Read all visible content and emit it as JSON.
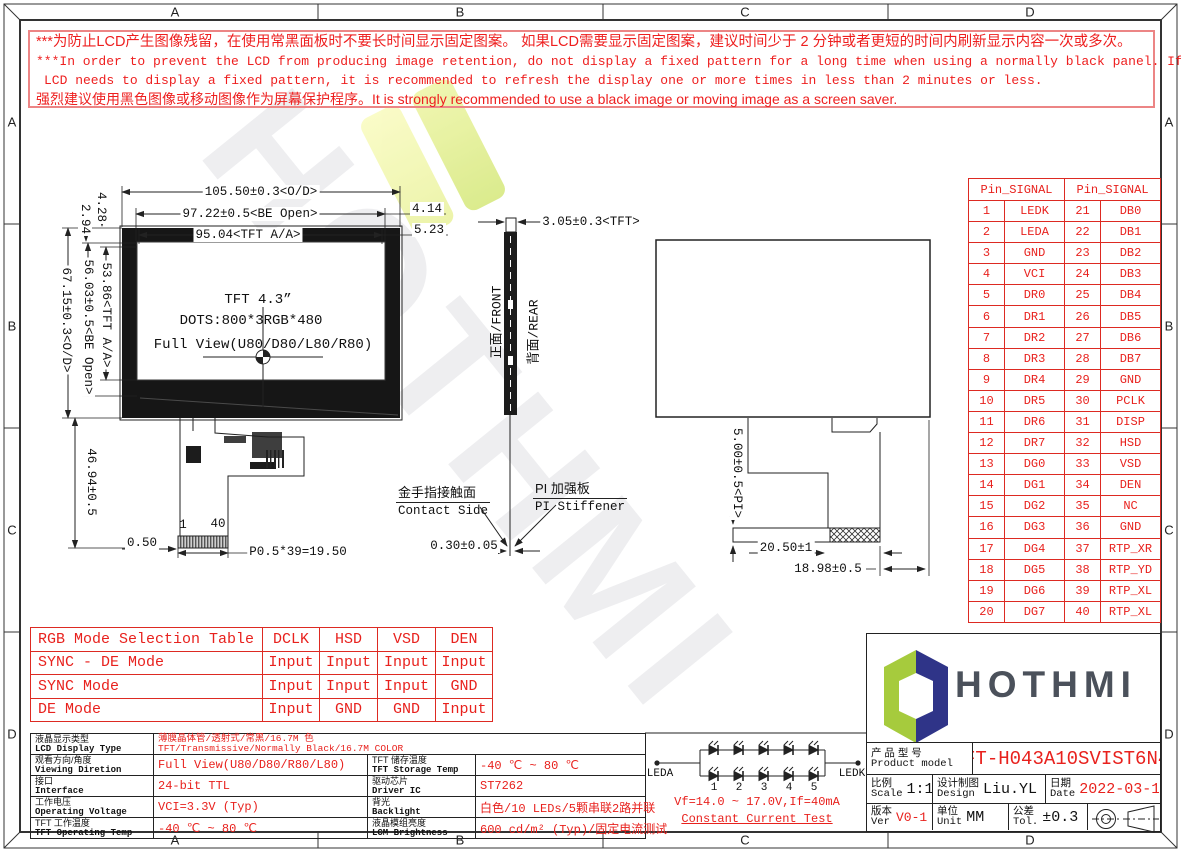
{
  "frame": {
    "zones": [
      "A",
      "B",
      "C",
      "D"
    ]
  },
  "warning": {
    "line1": "***为防止LCD产生图像残留，在使用常黑面板时不要长时间显示固定图案。 如果LCD需要显示固定图案，建议时间少于 2 分钟或者更短的时间内刷新显示内容一次或多次。",
    "line2": "***In order to prevent the LCD from producing image retention, do not display a fixed pattern for a long time when using a normally black panel. If the",
    "line3": "LCD needs to display a fixed pattern, it is recommended to refresh the display one or more times in less than 2 minutes or less.",
    "line4": "强烈建议使用黑色图像或移动图像作为屏幕保护程序。It is strongly recommended to use a black image or moving image as a screen saver."
  },
  "drawing": {
    "panel_text": {
      "line1": "TFT 4.3”",
      "line2": "DOTS:800*3RGB*480",
      "line3": "Full View(U80/D80/L80/R80)"
    },
    "dims": {
      "od_w": "105.50±0.3<O/D>",
      "be_w": "97.22±0.5<BE Open>",
      "aa_w": "95.04<TFT A/A>",
      "gap1": "4.14",
      "gap2": "5.23",
      "gap3": "4.28",
      "gap4": "2.94",
      "aa_h": "53.86<TFT A/A>",
      "be_h": "56.03±0.5<BE Open>",
      "od_h": "67.15±0.3<O/D>",
      "fpc_len": "46.94±0.5",
      "fpc_edge": "0.50",
      "pitch": "P0.5*39=19.50",
      "tft_t": "3.05±0.3<TFT>",
      "fpc_t": "0.30±0.05",
      "pi_h": "5.00±0.5<PI>",
      "pi_w": "20.50±1",
      "fpc_w": "18.98±0.5"
    },
    "pin_first": "1",
    "pin_last": "40",
    "side_labels": {
      "front": "正面/FRONT",
      "rear": "背面/REAR"
    },
    "callouts": {
      "contact_cn": "金手指接触面",
      "contact_en": "Contact Side",
      "stiffener_cn": "PI 加强板",
      "stiffener_en": "PI Stiffener"
    }
  },
  "pin_table": {
    "header": "Pin_SIGNAL",
    "rows": [
      [
        "1",
        "LEDK",
        "21",
        "DB0"
      ],
      [
        "2",
        "LEDA",
        "22",
        "DB1"
      ],
      [
        "3",
        "GND",
        "23",
        "DB2"
      ],
      [
        "4",
        "VCI",
        "24",
        "DB3"
      ],
      [
        "5",
        "DR0",
        "25",
        "DB4"
      ],
      [
        "6",
        "DR1",
        "26",
        "DB5"
      ],
      [
        "7",
        "DR2",
        "27",
        "DB6"
      ],
      [
        "8",
        "DR3",
        "28",
        "DB7"
      ],
      [
        "9",
        "DR4",
        "29",
        "GND"
      ],
      [
        "10",
        "DR5",
        "30",
        "PCLK"
      ],
      [
        "11",
        "DR6",
        "31",
        "DISP"
      ],
      [
        "12",
        "DR7",
        "32",
        "HSD"
      ],
      [
        "13",
        "DG0",
        "33",
        "VSD"
      ],
      [
        "14",
        "DG1",
        "34",
        "DEN"
      ],
      [
        "15",
        "DG2",
        "35",
        "NC"
      ],
      [
        "16",
        "DG3",
        "36",
        "GND"
      ],
      [
        "17",
        "DG4",
        "37",
        "RTP_XR"
      ],
      [
        "18",
        "DG5",
        "38",
        "RTP_YD"
      ],
      [
        "19",
        "DG6",
        "39",
        "RTP_XL"
      ],
      [
        "20",
        "DG7",
        "40",
        "RTP_XL"
      ]
    ]
  },
  "rgb_table": {
    "rows": [
      [
        "RGB Mode Selection Table",
        "DCLK",
        "HSD",
        "VSD",
        "DEN"
      ],
      [
        "SYNC - DE Mode",
        "Input",
        "Input",
        "Input",
        "Input"
      ],
      [
        "SYNC Mode",
        "Input",
        "Input",
        "Input",
        "GND"
      ],
      [
        "DE Mode",
        "Input",
        "GND",
        "GND",
        "Input"
      ]
    ]
  },
  "spec_table": {
    "r1": {
      "l_cn": "液晶显示类型",
      "l_en": "LCD Display Type",
      "v_cn": "薄膜晶体管/透射式/常黑/16.7M 色",
      "v_en": "TFT/Transmissive/Normally Black/16.7M COLOR"
    },
    "r2": {
      "l1_cn": "观看方向/角度",
      "l1_en": "Viewing Diretion",
      "v1": "Full View(U80/D80/R80/L80)",
      "l2_cn": "TFT 储存温度",
      "l2_en": "TFT Storage Temp",
      "v2": "-40 ℃ ~ 80 ℃"
    },
    "r3": {
      "l1_cn": "接口",
      "l1_en": "Interface",
      "v1": "24-bit TTL",
      "l2_cn": "驱动芯片",
      "l2_en": "Driver IC",
      "v2": "ST7262"
    },
    "r4": {
      "l1_cn": "工作电压",
      "l1_en": "Operating Voltage",
      "v1": "VCI=3.3V (Typ)",
      "l2_cn": "背光",
      "l2_en": "Backlight",
      "v2": "白色/10 LEDs/5颗串联2路并联"
    },
    "r5": {
      "l1_cn": "TFT 工作温度",
      "l1_en": "TFT Operating Temp",
      "v1": "-40 ℃ ~ 80 ℃",
      "l2_cn": "液晶模组亮度",
      "l2_en": "LCM Brightness",
      "v2": "600 cd/m² (Typ)/固定电流测试"
    }
  },
  "led_circuit": {
    "anode": "LEDA",
    "cathode": "LEDK",
    "numbers": [
      "1",
      "2",
      "3",
      "4",
      "5"
    ],
    "spec": "Vf=14.0 ~ 17.0V,If=40mA",
    "test": "Constant Current Test"
  },
  "title_block": {
    "brand": "HOTHMI",
    "product_cn": "产 品 型 号",
    "product_en": "Product model",
    "model": "TFT-H043A10SVIST6N40",
    "scale_cn": "比例",
    "scale_en": "Scale",
    "scale": "1:1",
    "design_cn": "设计制图",
    "design_en": "Design",
    "designer": "Liu.YL",
    "date_cn": "日期",
    "date_en": "Date",
    "date": "2022-03-10",
    "ver_cn": "版本",
    "ver_en": "Ver",
    "ver": "V0-1",
    "unit_cn": "单位",
    "unit_en": "Unit",
    "unit": "MM",
    "tol_cn": "公差",
    "tol_en": "Tol.",
    "tol": "±0.3"
  },
  "colors": {
    "red_text": "#e8211d",
    "table_border_red": "#dd2a22",
    "warning_border": "#ec8585",
    "line": "#222222",
    "logo_green": "#a6cb3d",
    "logo_navy": "#2f3488",
    "logo_text": "#4b515b"
  }
}
